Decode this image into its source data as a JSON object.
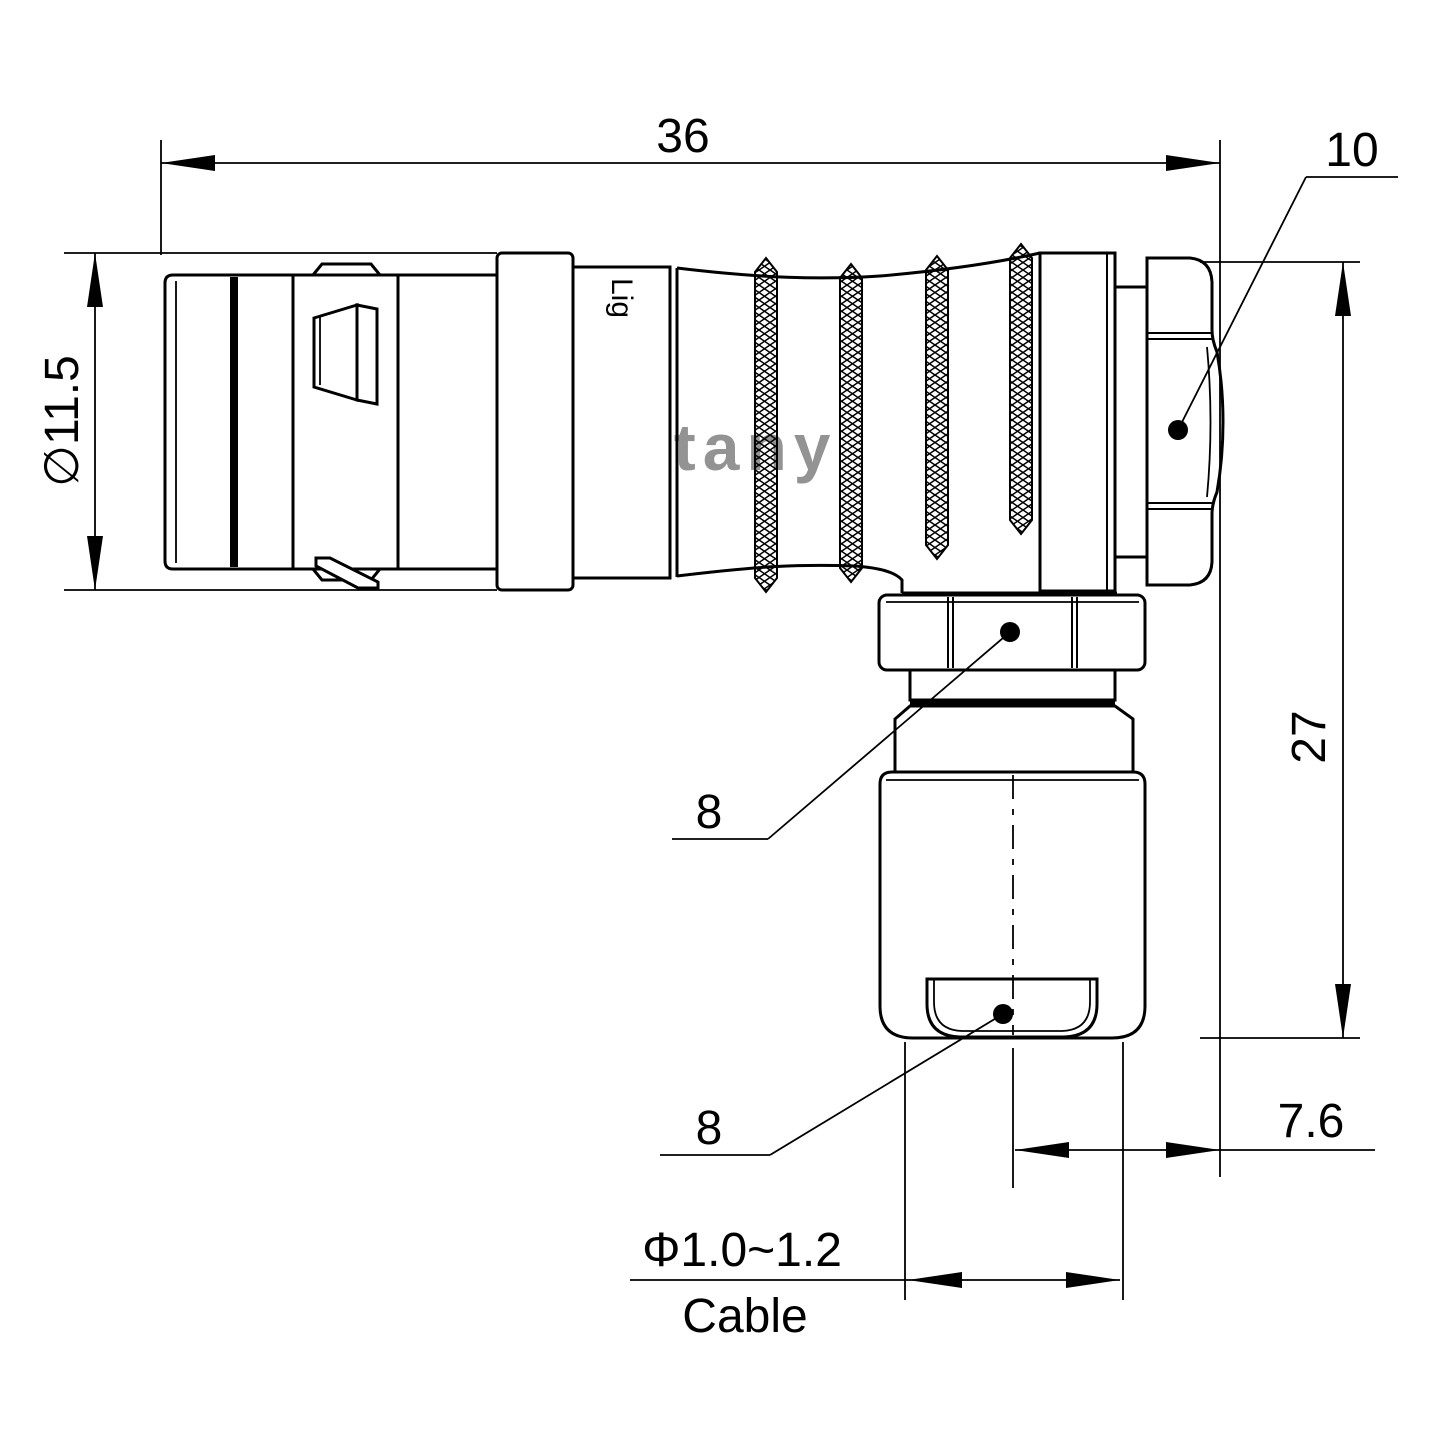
{
  "drawing": {
    "background": "#ffffff",
    "line_color": "#000000"
  },
  "watermark": {
    "text": "Lightany",
    "color": "#e09090"
  },
  "part_marking": {
    "text": "Lig"
  },
  "dimensions": {
    "total_length": "36",
    "cap_across_flats": "10",
    "shell_diameter": "∅11.5",
    "height": "27",
    "coupling_nut": "8",
    "gland_nut": "8",
    "cable_offset": "7.6",
    "cable_diameter_range": "Φ1.0~1.2",
    "cable_label": "Cable"
  }
}
